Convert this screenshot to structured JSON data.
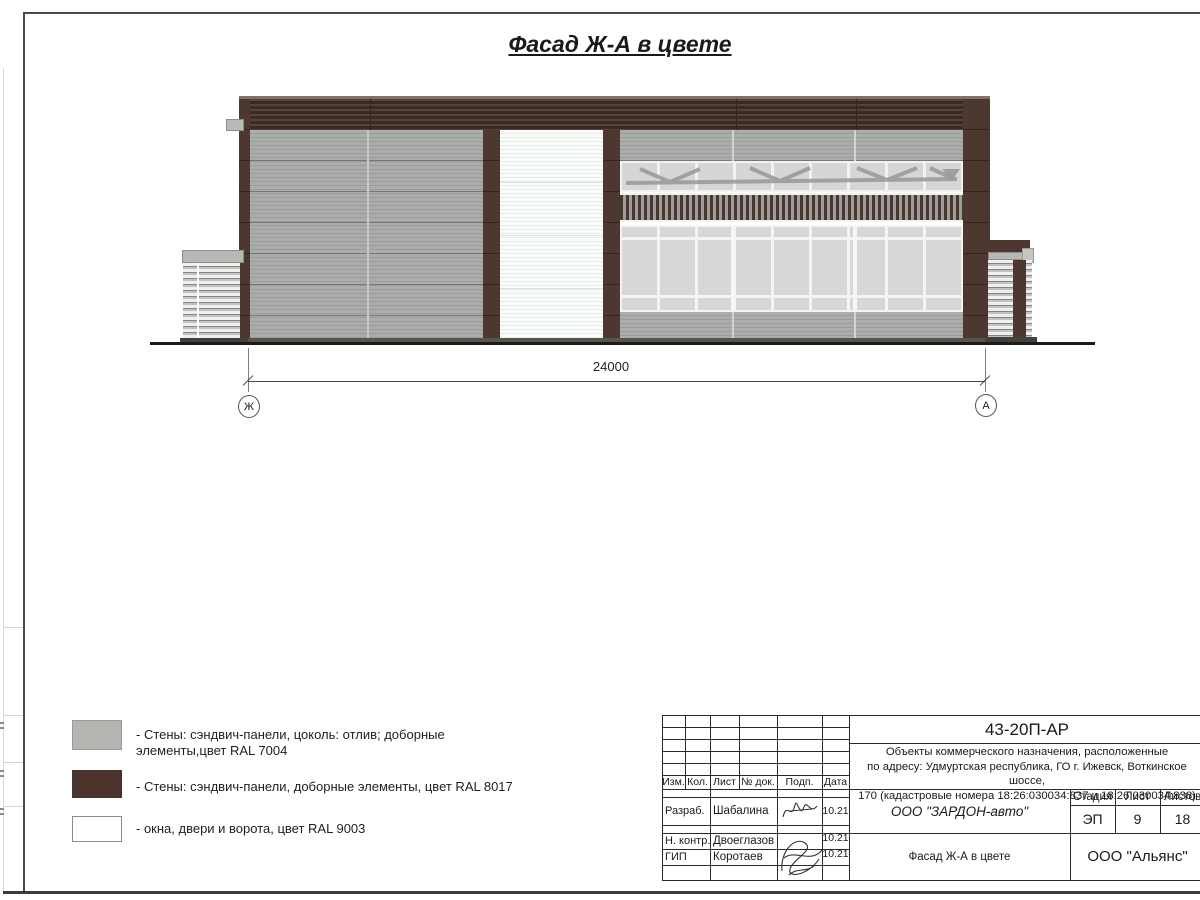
{
  "sheet": {
    "title": "Фасад Ж-А в цвете"
  },
  "drawing": {
    "dimension_value": "24000",
    "axis_left": "Ж",
    "axis_right": "А"
  },
  "legend": {
    "items": [
      {
        "label": "- Стены: сэндвич-панели, цоколь: отлив; доборные элементы,цвет RAL 7004",
        "swatch": "#b5b6b2"
      },
      {
        "label": "- Стены: сэндвич-панели, доборные элементы, цвет RAL 8017",
        "swatch": "#4a332c"
      },
      {
        "label": "- окна, двери и ворота, цвет RAL 9003",
        "swatch": "#ffffff"
      }
    ]
  },
  "title_block": {
    "doc_number": "43-20П-АР",
    "description_lines": [
      "Объекты коммерческого назначения, расположенные",
      "по адресу: Удмуртская республика, ГО г. Ижевск, Воткинское шоссе,",
      "170 (кадастровые номера 18:26:030034:837 и 18:26:030034:838)"
    ],
    "col_izm": "Изм.",
    "col_kol": "Кол.",
    "col_list": "Лист",
    "col_doc": "№ док.",
    "col_podp": "Подп.",
    "col_data": "Дата",
    "row1_role": "Разраб.",
    "row1_name": "Шабалина",
    "row1_date": "10.21",
    "row2_role": "Н. контр.",
    "row2_name": "Двоеглазов",
    "row2_date": "10.21",
    "row3_role": "ГИП",
    "row3_name": "Коротаев",
    "row3_date": "10.21",
    "company": "ООО \"ЗАРДОН-авто\"",
    "stage_label": "Стадия",
    "sheet_label": "Лист",
    "sheets_label": "Листов",
    "stage": "ЭП",
    "sheet_num": "9",
    "sheets_total": "18",
    "sheet_title": "Фасад Ж-А в цвете",
    "org": "ООО \"Альянс\""
  },
  "colors": {
    "ral7004_gray": "#b5b6b2",
    "ral8017_brown": "#4a332c",
    "ral9003_white": "#ffffff",
    "wall_gray": "#a9a9a7",
    "accent_brown": "#4c3831",
    "glass_gray": "#d7d8d5",
    "ground_line": "#1b1b1b"
  }
}
